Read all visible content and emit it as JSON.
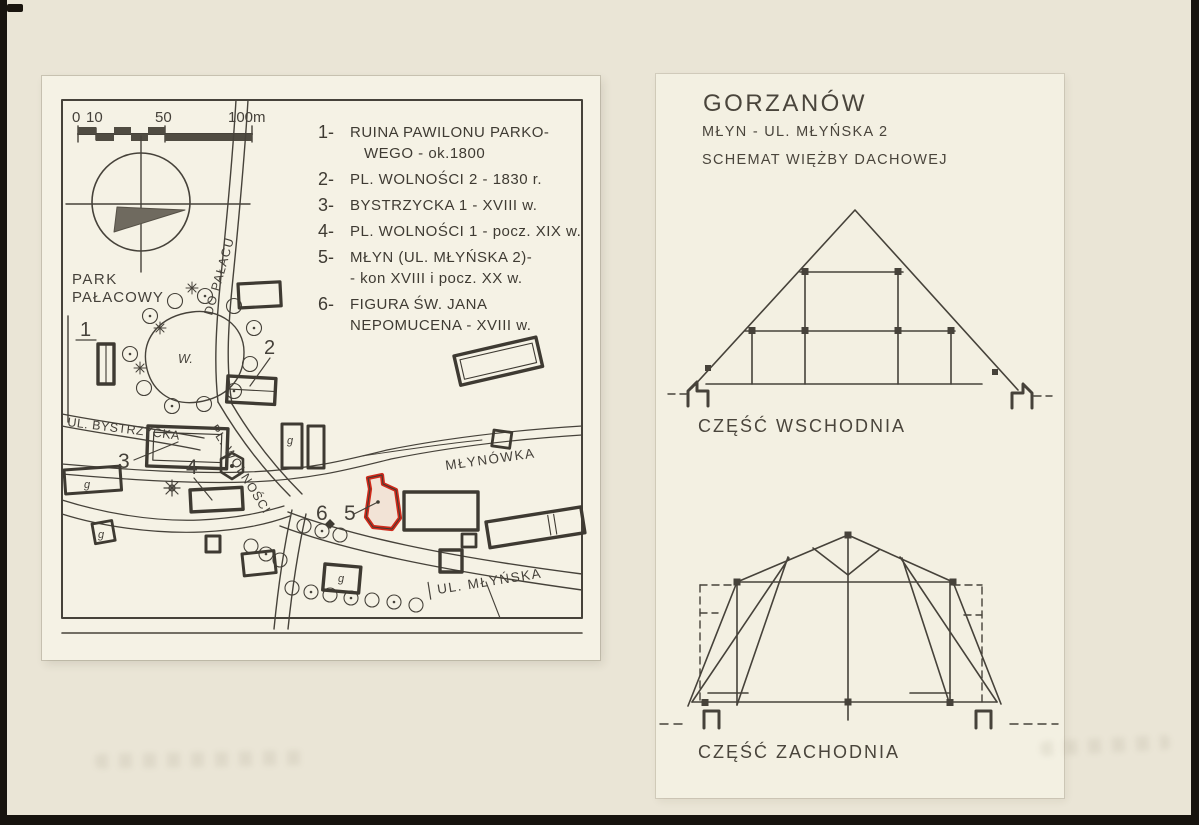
{
  "page": {
    "colors": {
      "background": "#eae5d6",
      "map_paper": "#f5f2e5",
      "panel_paper": "#f3f0e2",
      "ink": "#45413a",
      "highlight_red": "#d02a1b",
      "scan_edge": "#17130e"
    }
  },
  "map": {
    "scale_bar": {
      "tick_labels": [
        "0",
        "10",
        "50",
        "100m"
      ]
    },
    "labels": {
      "park_line1": "PARK",
      "park_line2": "PAŁACOWY",
      "pond": "W.",
      "road_to_palace": "DO PAŁACU",
      "street_bystrzycka": "UL. BYSTRZYCKA",
      "square_wolnosci": "PL. WOLNOŚCI",
      "mill_stream": "MŁYNÓWKA",
      "street_mlynska": "UL. MŁYŃSKA",
      "outbuilding": "g"
    },
    "numbers": {
      "n1": "1",
      "n2": "2",
      "n3": "3",
      "n4": "4",
      "n5": "5",
      "n6": "6"
    }
  },
  "legend": {
    "items": [
      {
        "n": "1-",
        "lines": [
          "RUINA PAWILONU PARKO-",
          "WEGO - ok.1800"
        ]
      },
      {
        "n": "2-",
        "lines": [
          "PL. WOLNOŚCI 2 - 1830 r."
        ]
      },
      {
        "n": "3-",
        "lines": [
          "BYSTRZYCKA 1 - XVIII w."
        ]
      },
      {
        "n": "4-",
        "lines": [
          "PL. WOLNOŚCI 1 - pocz. XIX w."
        ]
      },
      {
        "n": "5-",
        "lines": [
          "MŁYN (UL. MŁYŃSKA 2)-",
          "- kon XVIII i pocz. XX w."
        ]
      },
      {
        "n": "6-",
        "lines": [
          "FIGURA ŚW. JANA",
          "NEPOMUCENA - XVIII w."
        ]
      }
    ]
  },
  "panel": {
    "title": "GORZANÓW",
    "subtitle_line1": "MŁYN - UL. MŁYŃSKA 2",
    "subtitle_line2": "SCHEMAT WIĘŻBY DACHOWEJ",
    "east_caption": "CZĘŚĆ WSCHODNIA",
    "west_caption": "CZĘŚĆ ZACHODNIA"
  }
}
